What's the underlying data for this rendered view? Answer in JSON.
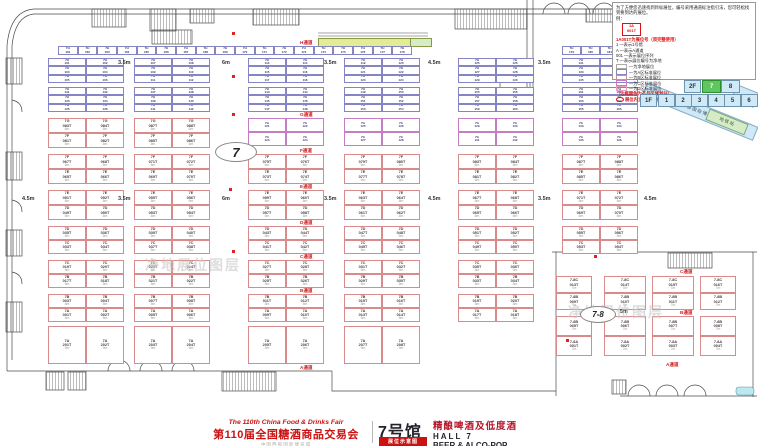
{
  "colors": {
    "booth_red": "#d98b8b",
    "booth_blue": "#8585c4",
    "booth_purple": "#c47fc4",
    "aisle_red": "#cc2222",
    "watermark": "#c7c7c7",
    "minimap_blue": "#cfe9f6",
    "minimap_active_green": "#5fc75f",
    "walkway_yellow": "#e3ec94",
    "walkway_green": "#d6ecc6",
    "legend_red": "#dd1111"
  },
  "legend": {
    "intro": "为了方便您迅速找到目标展位，编号采用通道标注指引法，您可轻松找到要到达的展位。",
    "example_label": "例：",
    "sample_top": "1A",
    "sample_bottom": "001T",
    "sample_caption": "1A001T为展位号（须完整使用）",
    "items": [
      "1 —表示1号馆",
      "A —表示A通道",
      "001 —表示展位序列",
      "T —表示展位编号为净地"
    ],
    "swatches": [
      {
        "border": "#aaaaaa",
        "label": "—为净地展位"
      },
      {
        "border": "#8585c4",
        "label": "—为A区标准展位"
      },
      {
        "border": "#d98b8b",
        "label": "—为B区标准展位"
      },
      {
        "border": "#c47fc4",
        "label": "—为C区标准展位"
      },
      {
        "border": "#e8a0b8",
        "label": "—为D区标准展位"
      }
    ],
    "notes": [
      "（边框颜色为产品区域划分）",
      "展位内立柱 直径均为1.5m"
    ]
  },
  "minimap": {
    "floor2_label": "2F",
    "floor2_halls": [
      {
        "label": "7",
        "active": true
      },
      {
        "label": "8",
        "active": false
      }
    ],
    "floor1_label": "1F",
    "floor1_halls": [
      "1",
      "2",
      "3",
      "4",
      "5",
      "6"
    ],
    "wing_label": "西部国际博览城",
    "wing_end_label": "9",
    "badge_label": "地铁站"
  },
  "title": {
    "fair_en": "The 110th China Food & Drinks Fair",
    "fair_cn": "第110届全国糖酒商品交易会",
    "venue": "中国西部国际博览城",
    "hall_cn": "7号馆",
    "badge": "展位示意图",
    "category_cn": "精酿啤酒及低度酒",
    "hall_en": "HALL 7",
    "category_en": "BEER & ALCO-POP"
  },
  "floor": {
    "aisle_labels": [
      {
        "text": "H通道",
        "x": 300,
        "y": 40
      },
      {
        "text": "G通道",
        "x": 300,
        "y": 112
      },
      {
        "text": "F通道",
        "x": 300,
        "y": 148
      },
      {
        "text": "E通道",
        "x": 300,
        "y": 184
      },
      {
        "text": "D通道",
        "x": 300,
        "y": 220
      },
      {
        "text": "C通道",
        "x": 300,
        "y": 254
      },
      {
        "text": "B通道",
        "x": 300,
        "y": 288
      },
      {
        "text": "A通道",
        "x": 300,
        "y": 365
      },
      {
        "text": "C通道",
        "x": 680,
        "y": 269
      },
      {
        "text": "B通道",
        "x": 680,
        "y": 310
      },
      {
        "text": "A通道",
        "x": 666,
        "y": 362
      }
    ],
    "dim_labels": [
      {
        "text": "3.5m",
        "x": 118,
        "y": 60
      },
      {
        "text": "6m",
        "x": 222,
        "y": 60
      },
      {
        "text": "3.5m",
        "x": 324,
        "y": 60
      },
      {
        "text": "4.5m",
        "x": 428,
        "y": 60
      },
      {
        "text": "3.5m",
        "x": 538,
        "y": 60
      },
      {
        "text": "4.5m",
        "x": 22,
        "y": 196
      },
      {
        "text": "3.5m",
        "x": 118,
        "y": 196
      },
      {
        "text": "6m",
        "x": 222,
        "y": 196
      },
      {
        "text": "3.5m",
        "x": 324,
        "y": 196
      },
      {
        "text": "4.5m",
        "x": 428,
        "y": 196
      },
      {
        "text": "3.5m",
        "x": 538,
        "y": 196
      },
      {
        "text": "4.5m",
        "x": 644,
        "y": 196
      },
      {
        "text": "5m",
        "x": 620,
        "y": 309
      }
    ],
    "watermarks": [
      {
        "text": "净地展位图层",
        "x": 145,
        "y": 255
      },
      {
        "text": "净地展位图层",
        "x": 568,
        "y": 302
      }
    ],
    "ovals": [
      {
        "text": "7",
        "x": 215,
        "y": 142,
        "w": 40,
        "h": 18,
        "fs": 13
      },
      {
        "text": "7-8",
        "x": 580,
        "y": 306,
        "w": 34,
        "h": 15,
        "fs": 8
      }
    ],
    "markers": [
      [
        232,
        32
      ],
      [
        232,
        75
      ],
      [
        232,
        113
      ],
      [
        229,
        188
      ],
      [
        232,
        250
      ],
      [
        594,
        255
      ],
      [
        566,
        339
      ]
    ],
    "walkway": [
      {
        "x": 318,
        "y": 38,
        "w": 92,
        "h": 7,
        "c": "#e3ec94"
      },
      {
        "x": 410,
        "y": 38,
        "w": 20,
        "h": 7,
        "c": "#d6ecc6"
      }
    ],
    "groups": [
      [
        48,
        76
      ],
      [
        134,
        76
      ],
      [
        248,
        76
      ],
      [
        344,
        76
      ],
      [
        458,
        76
      ],
      [
        562,
        76
      ]
    ],
    "blue_prefix": "7H",
    "blue_strips": [
      {
        "x": 58,
        "w": 354,
        "n": 18,
        "base": 161
      },
      {
        "x": 562,
        "w": 76,
        "n": 4,
        "base": 179
      }
    ],
    "blue_bands": [
      {
        "y": 58,
        "h": 25,
        "rows": 3,
        "base": 101
      },
      {
        "y": 87,
        "h": 25,
        "rows": 3,
        "base": 131
      }
    ],
    "mini_band": {
      "y": 118,
      "h": 28,
      "rows": 2,
      "groups": [
        2,
        3,
        4,
        5
      ],
      "prefix": "7G",
      "base": 121
    },
    "pair_bands": [
      {
        "y": 118,
        "h": 30,
        "groups": [
          0,
          1
        ],
        "top": "7G",
        "bottom": "7F",
        "base": 81,
        "size": "6m"
      },
      {
        "y": 154,
        "h": 30,
        "groups": [
          0,
          1,
          2,
          3,
          4,
          5
        ],
        "top": "7F",
        "bottom": "7E",
        "base": 65,
        "size": "6m"
      },
      {
        "y": 190,
        "h": 30,
        "groups": [
          0,
          1,
          2,
          3,
          4,
          5
        ],
        "top": "7E",
        "bottom": "7D",
        "base": 49,
        "size": "6m"
      },
      {
        "y": 226,
        "h": 28,
        "groups": [
          0,
          1,
          2,
          3,
          4,
          5
        ],
        "top": "7D",
        "bottom": "7C",
        "base": 33,
        "size": "5m"
      },
      {
        "y": 260,
        "h": 28,
        "groups": [
          0,
          1,
          2,
          3,
          4
        ],
        "top": "7C",
        "bottom": "7B",
        "base": 17,
        "size": "5m"
      },
      {
        "y": 294,
        "h": 28,
        "groups": [
          0,
          1,
          2,
          3,
          4
        ],
        "top": "7B",
        "bottom": "7A",
        "base": 1,
        "size": "5m"
      }
    ],
    "single_band": {
      "y": 326,
      "h": 38,
      "groups": [
        0,
        1,
        2,
        3
      ],
      "prefix": "7A",
      "base": 201,
      "size": "9m"
    },
    "sub": {
      "cols": [
        [
          556,
          36
        ],
        [
          604,
          42
        ],
        [
          652,
          42
        ],
        [
          700,
          36
        ]
      ],
      "bands": [
        {
          "y": 276,
          "h": 34,
          "top": "7-8C",
          "tb": 13,
          "bottom": "7-8B",
          "bb": 9,
          "size": "7m"
        },
        {
          "y": 316,
          "h": 40,
          "top": "7-8B",
          "tb": 5,
          "bottom": "7-8A",
          "bb": 1,
          "size": "7m"
        }
      ]
    }
  }
}
